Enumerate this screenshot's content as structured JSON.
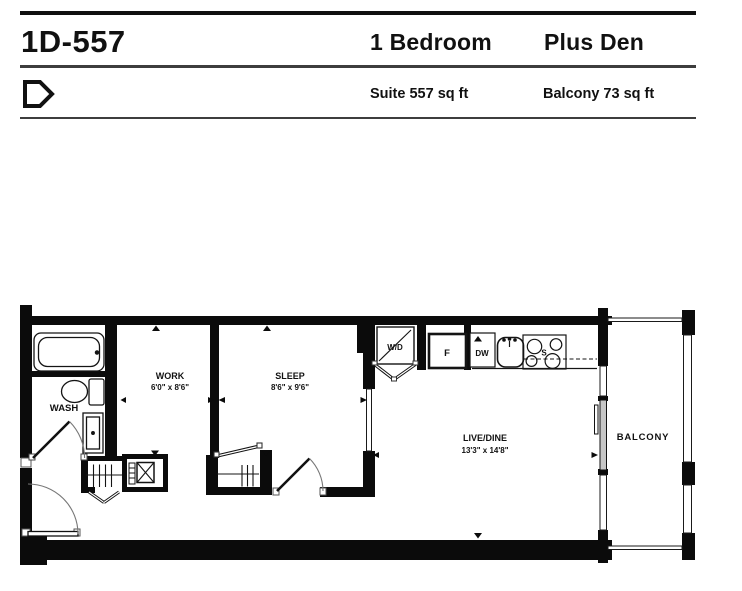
{
  "header": {
    "unit_code": "1D-557",
    "bedroom_label": "1 Bedroom",
    "den_label": "Plus Den",
    "suite_sqft": "Suite 557 sq ft",
    "balcony_sqft": "Balcony 73 sq ft"
  },
  "floorplan": {
    "rooms": {
      "wash": {
        "label": "WASH"
      },
      "work": {
        "label": "WORK",
        "dims": "6'0\" x 8'6\""
      },
      "sleep": {
        "label": "SLEEP",
        "dims": "8'6\" x 9'6\""
      },
      "live_dine": {
        "label": "LIVE/DINE",
        "dims": "13'3\" x 14'8\""
      },
      "balcony": {
        "label": "BALCONY"
      }
    },
    "fixtures": {
      "washer_dryer": "W/D",
      "fridge": "F",
      "dishwasher": "DW",
      "stove": "S"
    },
    "colors": {
      "wall": "#0b0b0b",
      "text": "#111111"
    }
  }
}
